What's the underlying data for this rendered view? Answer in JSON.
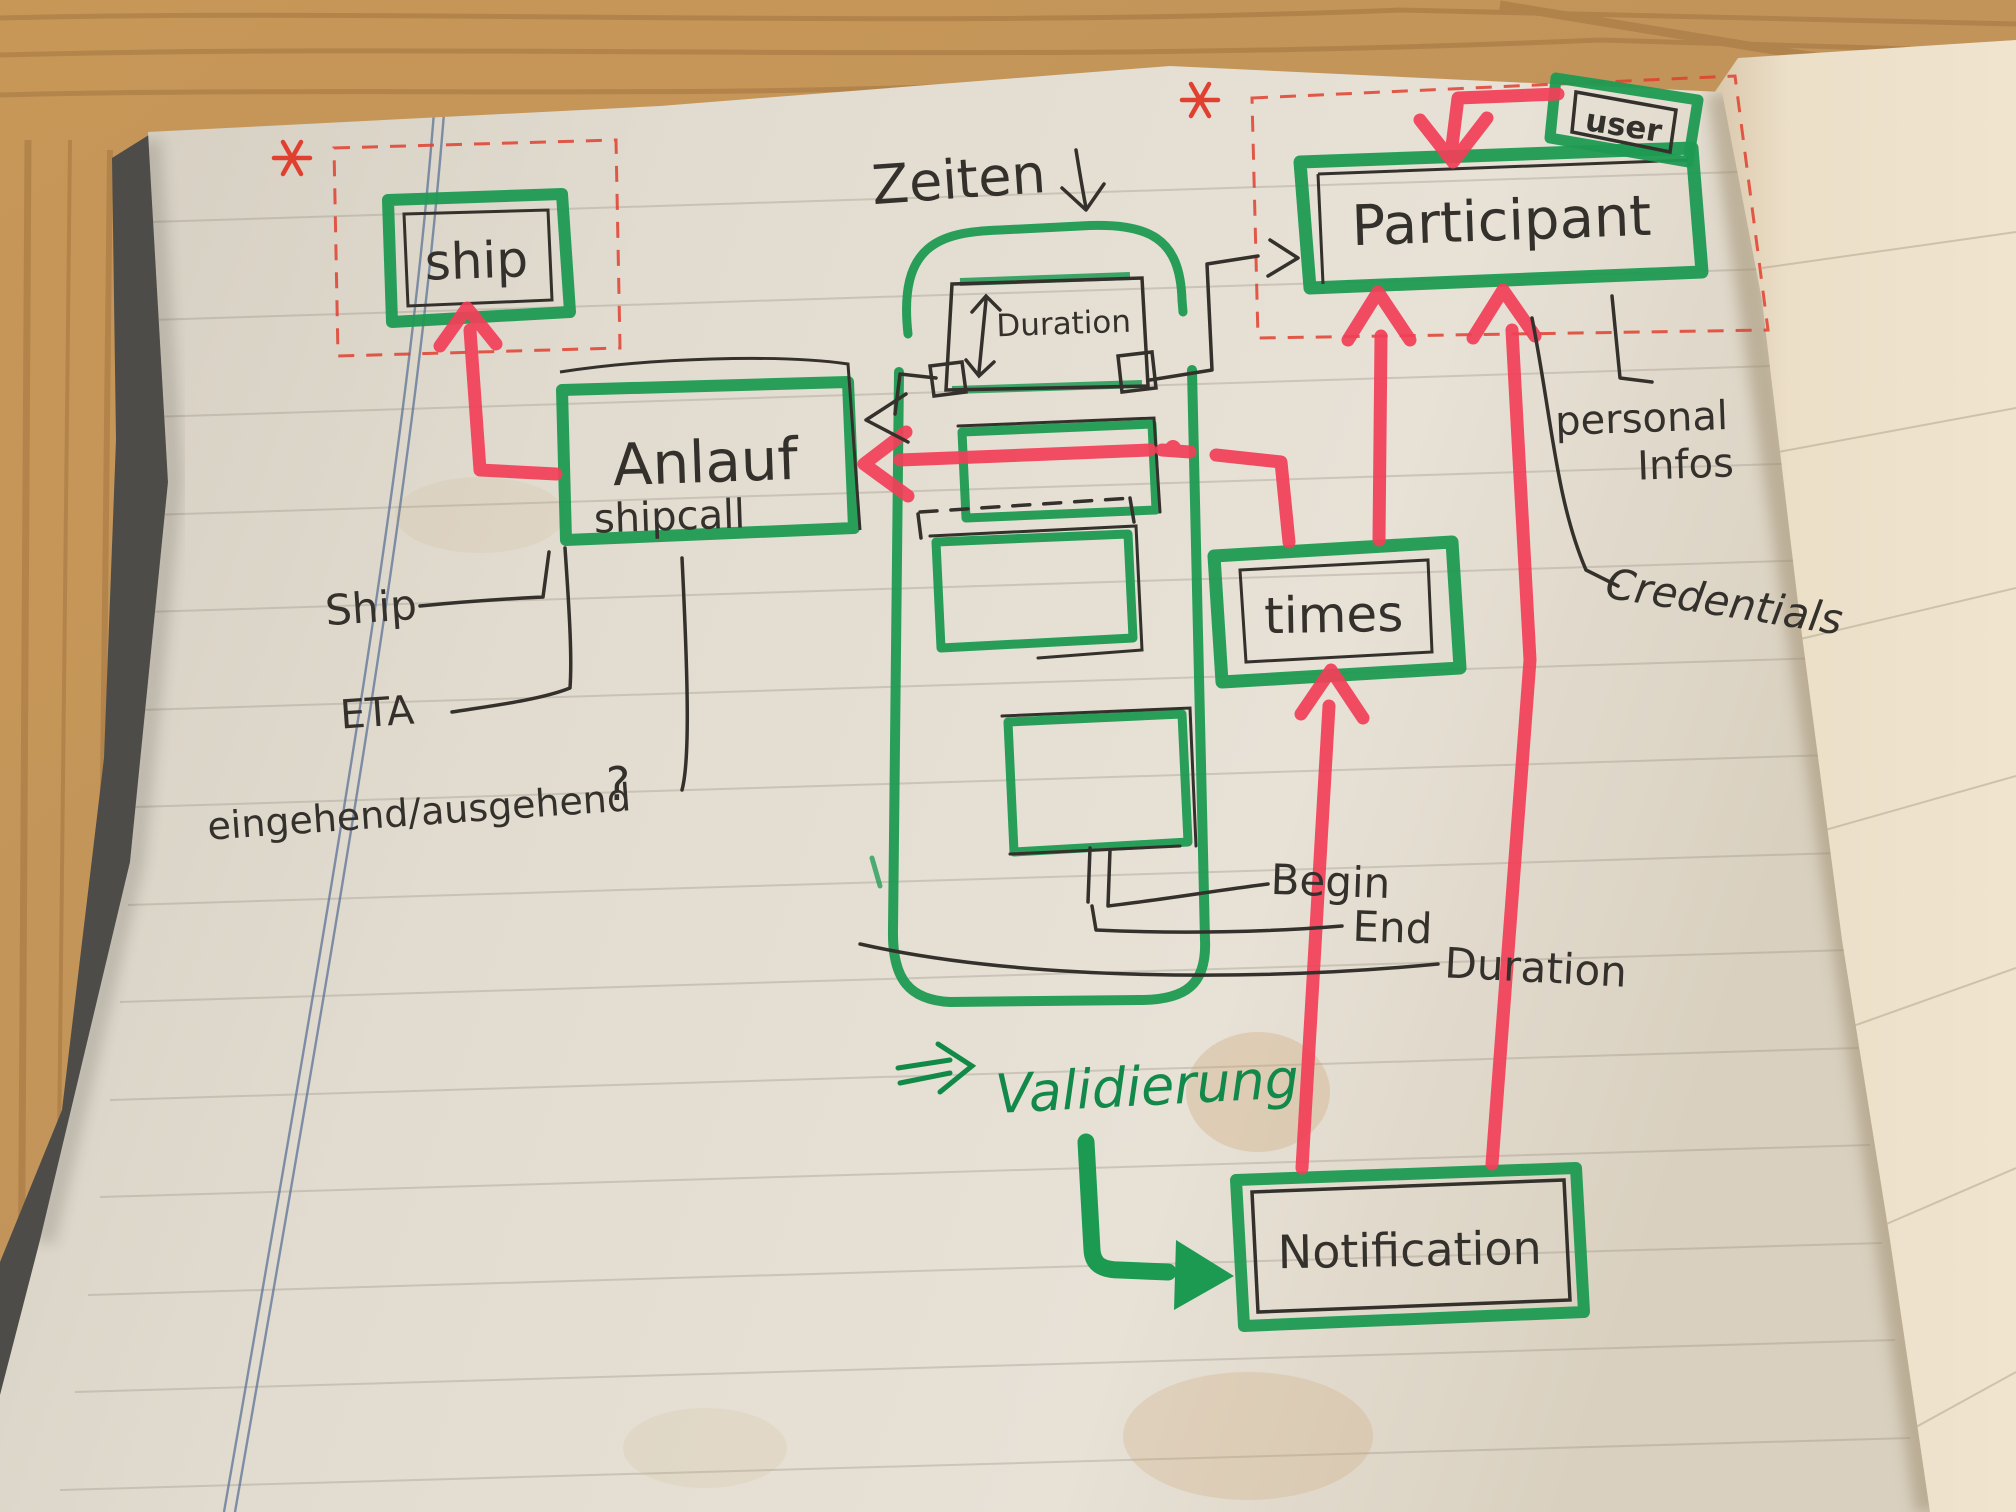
{
  "scene": {
    "description_labels": {
      "zeiten": "Zeiten",
      "validierung": "Validierung"
    },
    "entities": {
      "ship": "ship",
      "anlauf": "Anlauf",
      "shipcall": "shipcall",
      "duration_box": "Duration",
      "user": "user",
      "participant": "Participant",
      "times": "times",
      "notification": "Notification"
    },
    "field_labels": {
      "ship": "Ship",
      "eta": "ETA",
      "direction": "eingehend/ausgehend",
      "direction_question": "?",
      "begin": "Begin",
      "end": "End",
      "duration": "Duration",
      "personal_line1": "personal",
      "personal_line2": "Infos",
      "credentials": "Credentials"
    },
    "marks": {
      "asterisk_ship": "*",
      "asterisk_participant": "*",
      "implies_arrow": "⇒",
      "down_arrow": "↓",
      "l_arrow": "↳"
    },
    "colors": {
      "marker_green": "#1d9a52",
      "pen_green": "#118a48",
      "marker_red": "#f23f58",
      "pen_red": "#e0402f",
      "ink_black": "#34312c",
      "margin_blue": "#5c7396",
      "page_cream": "#e2dcd0",
      "next_page": "#ecdfc8",
      "wood": "#c2945a",
      "cover_dark": "#4e4c49"
    }
  }
}
